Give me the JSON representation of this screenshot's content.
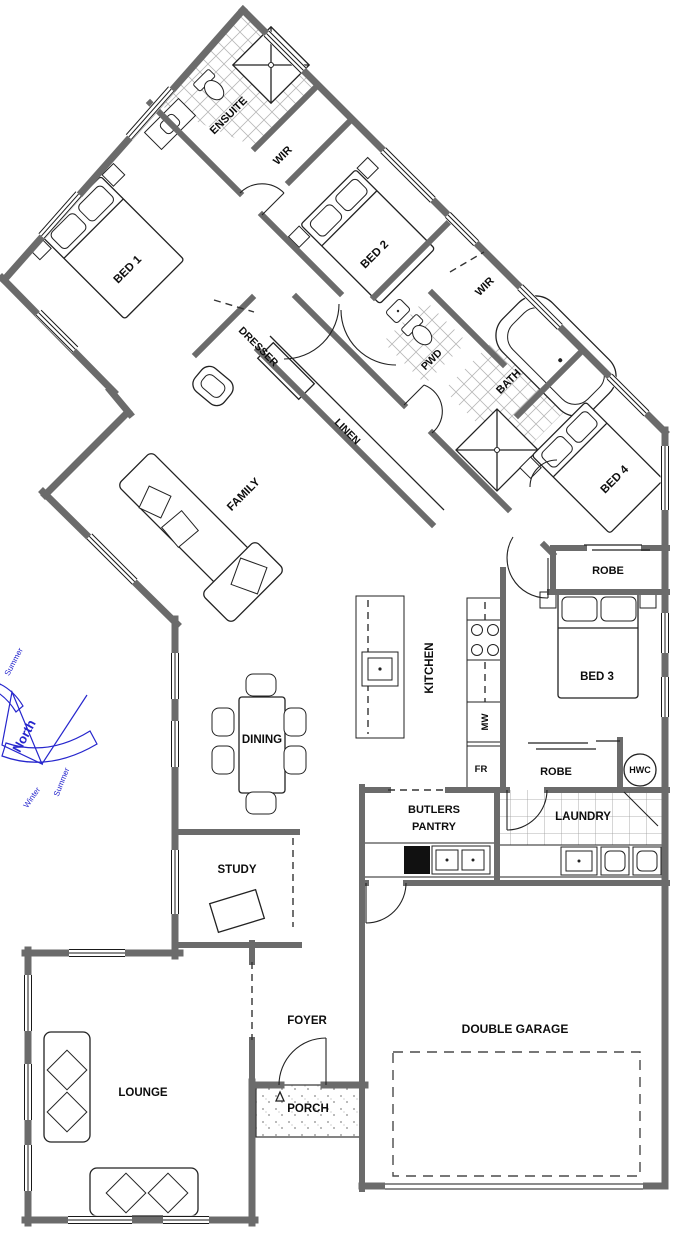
{
  "title": "House Floor Plan",
  "colors": {
    "wall": "#6b6b6b",
    "line": "#1c1c1c",
    "compass": "#2626cd",
    "tile": "#b8b8b8",
    "shade": "#dce9f7"
  },
  "rooms": {
    "bed1": "BED 1",
    "ensuite": "ENSUITE",
    "wir_ensuite": "WIR",
    "bed2": "BED 2",
    "wir_bed2": "WIR",
    "dresser": "DRESSER",
    "pwd": "PWD",
    "bath": "BATH",
    "bed4": "BED 4",
    "linen": "LINEN",
    "family": "FAMILY",
    "robe_bed4": "ROBE",
    "kitchen": "KITCHEN",
    "mw": "MW",
    "fr": "FR",
    "bed3": "BED 3",
    "robe_bed3": "ROBE",
    "hwc": "HWC",
    "dining": "DINING",
    "butlers_pantry_line1": "BUTLERS",
    "butlers_pantry_line2": "PANTRY",
    "laundry": "LAUNDRY",
    "study": "STUDY",
    "foyer": "FOYER",
    "porch": "PORCH",
    "lounge": "LOUNGE",
    "double_garage": "DOUBLE GARAGE"
  },
  "compass": {
    "north": "North",
    "summer": "Summer",
    "winter": "Winter"
  }
}
